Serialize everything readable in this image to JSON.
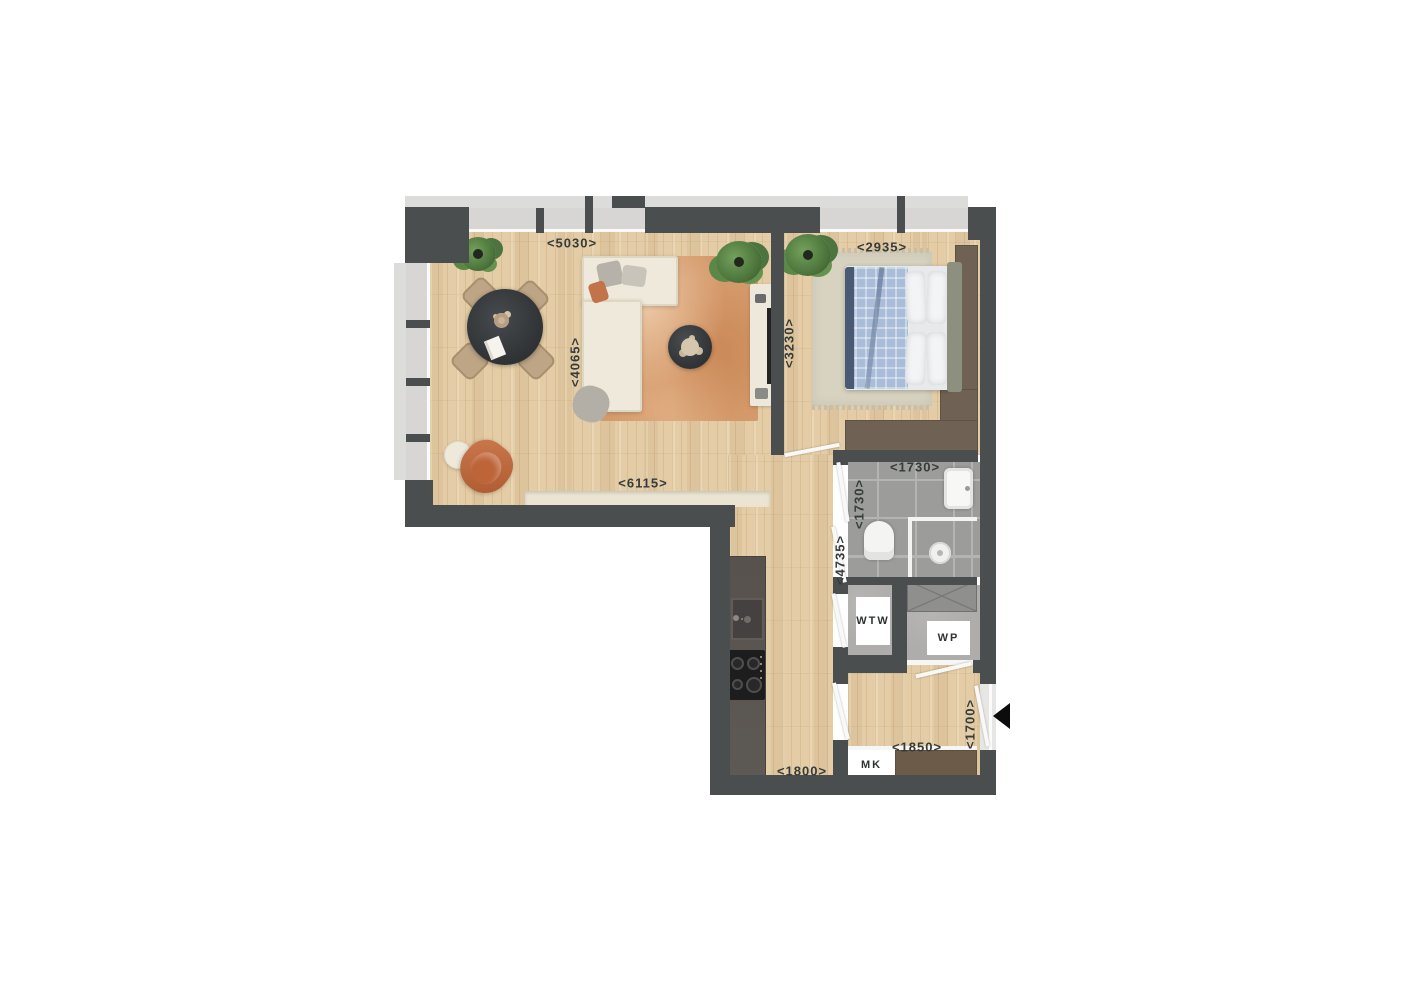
{
  "plan": {
    "labels": {
      "dim5030": "<5030>",
      "dim2935": "<2935>",
      "dim4065": "<4065>",
      "dim3230": "<3230>",
      "dim6115": "<6115>",
      "dim1730h": "<1730>",
      "dim1730v": "<1730>",
      "dim4735": "<4735>",
      "dim1850": "<1850>",
      "dim1700": "<1700>",
      "dim1800": "<1800>",
      "wtw": "WTW",
      "wp": "WP",
      "mk": "MK"
    },
    "colors": {
      "wall": "#4a4e4e",
      "wood_floor": "#e4cda6",
      "bathroom_tile": "#9c9c9a",
      "living_rug": "#d59a6c",
      "bedroom_rug": "#d8d2c0",
      "duvet_blue": "#a9bdd9",
      "wardrobe_brown": "#6f6254",
      "armchair_terracotta": "#c06a3f",
      "label_text": "#363b3b"
    },
    "entrance_arrow_direction": "left"
  }
}
